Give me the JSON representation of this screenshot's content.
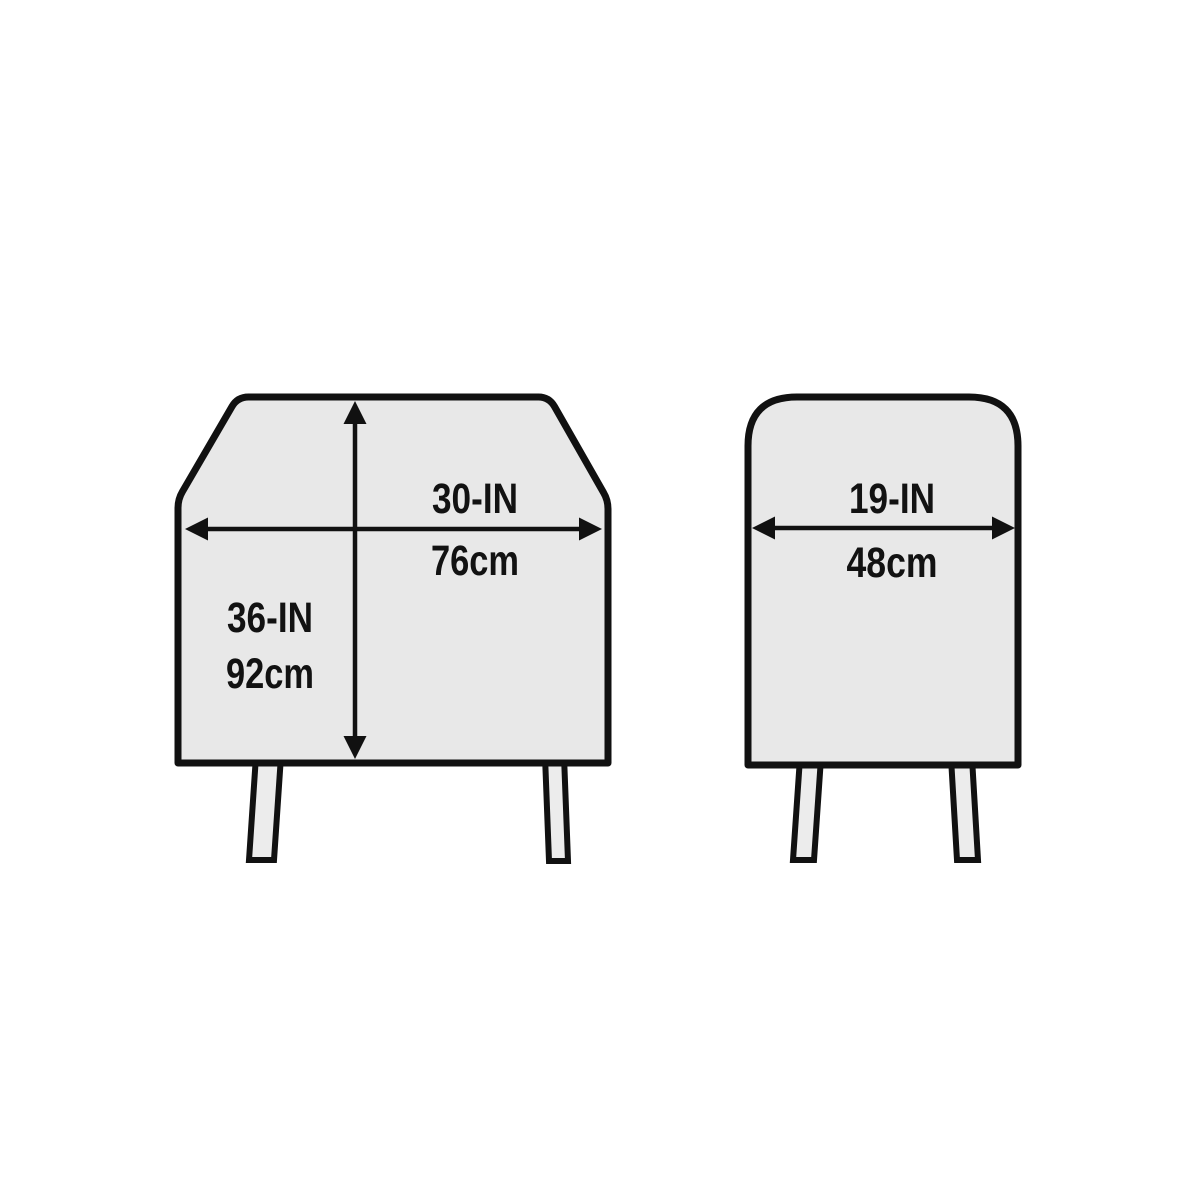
{
  "diagram": {
    "title": "grill-cover-dimensions",
    "colors": {
      "background": "#ffffff",
      "outline": "#111111",
      "body_fill": "#e8e8e8",
      "leg_fill": "#ececec",
      "text": "#121212"
    },
    "front_view": {
      "width_label_in": "30-IN",
      "width_label_cm": "76cm",
      "height_label_in": "36-IN",
      "height_label_cm": "92cm"
    },
    "side_view": {
      "depth_label_in": "19-IN",
      "depth_label_cm": "48cm"
    }
  }
}
